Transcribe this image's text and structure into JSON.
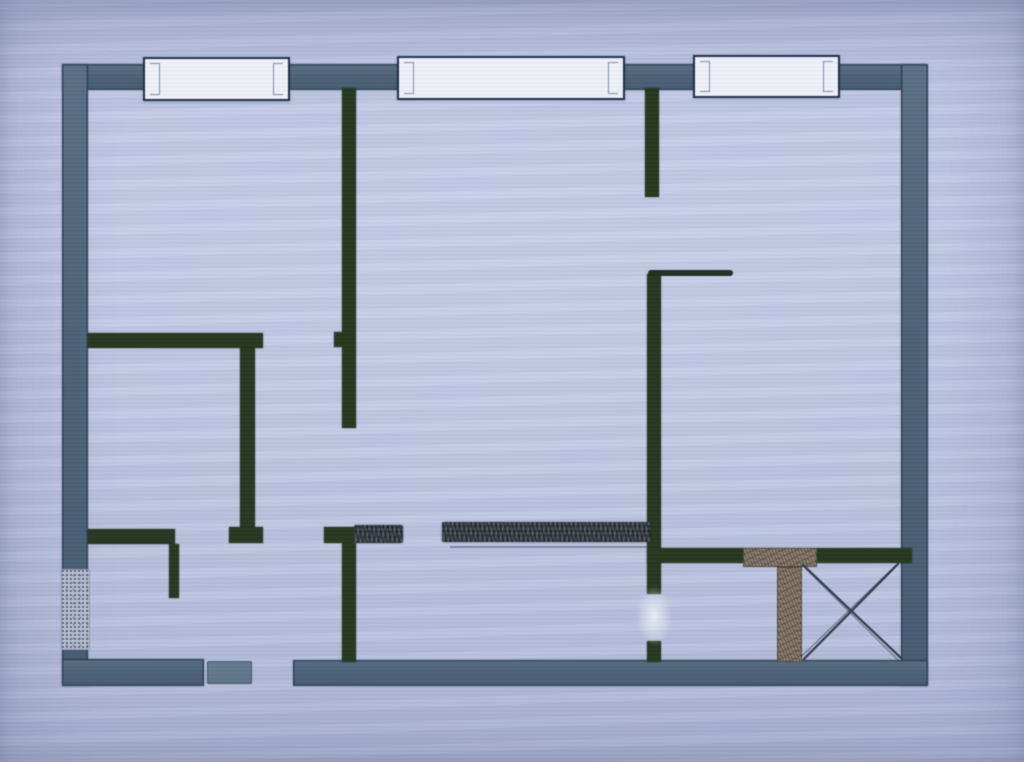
{
  "document": {
    "type": "floor-plan-photo",
    "description_visible_text": ""
  },
  "palette": {
    "paper": "#bdc5e1",
    "outer_wall": "#4d6277",
    "outer_wall_hi": "#5a6f84",
    "outer_wall_lo": "#465b70",
    "outer_wall_edge": "#2f4257",
    "inner_wall": "#27371f",
    "window_fill": "#edf0f6",
    "window_border": "#1e2d49",
    "hatch_dark": "#41474f",
    "hatch_brown": "#87796a",
    "speckle_base": "#b7bdd0",
    "door_block": "#5d7286",
    "thin_line": "#222e20",
    "cross_line": "#2e3a46"
  },
  "plan": {
    "canvas": {
      "width": 1024,
      "height": 762
    },
    "elements": [
      {
        "name": "top-exterior-wall",
        "kind": "outer",
        "x": 62,
        "y": 64,
        "w": 863,
        "h": 26
      },
      {
        "name": "left-exterior-wall",
        "kind": "outer",
        "x": 62,
        "y": 64,
        "w": 26,
        "h": 622
      },
      {
        "name": "right-exterior-wall",
        "kind": "outer",
        "x": 901,
        "y": 64,
        "w": 27,
        "h": 622
      },
      {
        "name": "bottom-exterior-wall-left",
        "kind": "outer",
        "x": 62,
        "y": 659,
        "w": 142,
        "h": 27
      },
      {
        "name": "bottom-exterior-wall-main",
        "kind": "outer",
        "x": 293,
        "y": 660,
        "w": 635,
        "h": 26
      },
      {
        "name": "left-wall-hatched-opening",
        "kind": "speckle",
        "x": 61,
        "y": 569,
        "w": 29,
        "h": 81
      },
      {
        "name": "entry-door-leaf",
        "kind": "door-block",
        "x": 207,
        "y": 661,
        "w": 45,
        "h": 23
      },
      {
        "name": "partition-center-upper",
        "kind": "inner",
        "x": 342,
        "y": 88,
        "w": 14,
        "h": 340
      },
      {
        "name": "partition-center-upper-jamb",
        "kind": "inner",
        "x": 334,
        "y": 332,
        "w": 8,
        "h": 15
      },
      {
        "name": "left-room-wall-horizontal",
        "kind": "inner",
        "x": 88,
        "y": 333,
        "w": 175,
        "h": 15
      },
      {
        "name": "left-room-wall-vertical",
        "kind": "inner",
        "x": 240,
        "y": 348,
        "w": 15,
        "h": 179
      },
      {
        "name": "left-room-wall-foot",
        "kind": "inner",
        "x": 229,
        "y": 527,
        "w": 34,
        "h": 16
      },
      {
        "name": "lower-left-wall-horizontal",
        "kind": "inner",
        "x": 88,
        "y": 529,
        "w": 87,
        "h": 15
      },
      {
        "name": "lower-left-wall-vertical",
        "kind": "inner",
        "x": 169,
        "y": 544,
        "w": 10,
        "h": 54
      },
      {
        "name": "partition-center-lower-horizontal",
        "kind": "inner",
        "x": 324,
        "y": 527,
        "w": 30,
        "h": 16
      },
      {
        "name": "partition-center-lower-vertical",
        "kind": "inner",
        "x": 342,
        "y": 543,
        "w": 14,
        "h": 119
      },
      {
        "name": "partition-right-upper",
        "kind": "inner",
        "x": 645,
        "y": 88,
        "w": 14,
        "h": 109
      },
      {
        "name": "partition-right-middle",
        "kind": "inner",
        "x": 647,
        "y": 274,
        "w": 14,
        "h": 320
      },
      {
        "name": "partition-right-lower-stub",
        "kind": "inner",
        "x": 647,
        "y": 641,
        "w": 14,
        "h": 21
      },
      {
        "name": "bathroom-wall-horizontal",
        "kind": "inner",
        "x": 647,
        "y": 548,
        "w": 265,
        "h": 15
      },
      {
        "name": "hatched-wall-segment-short",
        "kind": "hatch-dark",
        "x": 354,
        "y": 525,
        "w": 49,
        "h": 18
      },
      {
        "name": "hatched-wall-segment-long",
        "kind": "hatch-dark",
        "x": 442,
        "y": 522,
        "w": 208,
        "h": 20
      },
      {
        "name": "hatched-duct-horizontal",
        "kind": "hatch-brown",
        "x": 743,
        "y": 548,
        "w": 74,
        "h": 19
      },
      {
        "name": "hatched-duct-vertical",
        "kind": "hatch-brown",
        "x": 777,
        "y": 567,
        "w": 25,
        "h": 95
      },
      {
        "name": "counter-ledge-line",
        "kind": "thin-line",
        "x": 648,
        "y": 270,
        "w": 85,
        "h": 6
      },
      {
        "name": "pencil-underline",
        "kind": "faint-line",
        "x": 450,
        "y": 546,
        "w": 200,
        "h": 2
      },
      {
        "name": "paper-smudge",
        "kind": "smudge",
        "x": 636,
        "y": 586,
        "w": 36,
        "h": 60
      },
      {
        "name": "window-1",
        "kind": "window",
        "x": 143,
        "y": 57,
        "w": 147,
        "h": 44
      },
      {
        "name": "window-2",
        "kind": "window",
        "x": 397,
        "y": 56,
        "w": 228,
        "h": 44
      },
      {
        "name": "window-3",
        "kind": "window",
        "x": 693,
        "y": 55,
        "w": 147,
        "h": 43
      }
    ],
    "cross_box": {
      "name": "shaft-cross-box",
      "x": 802,
      "y": 563,
      "w": 100,
      "h": 97
    }
  }
}
